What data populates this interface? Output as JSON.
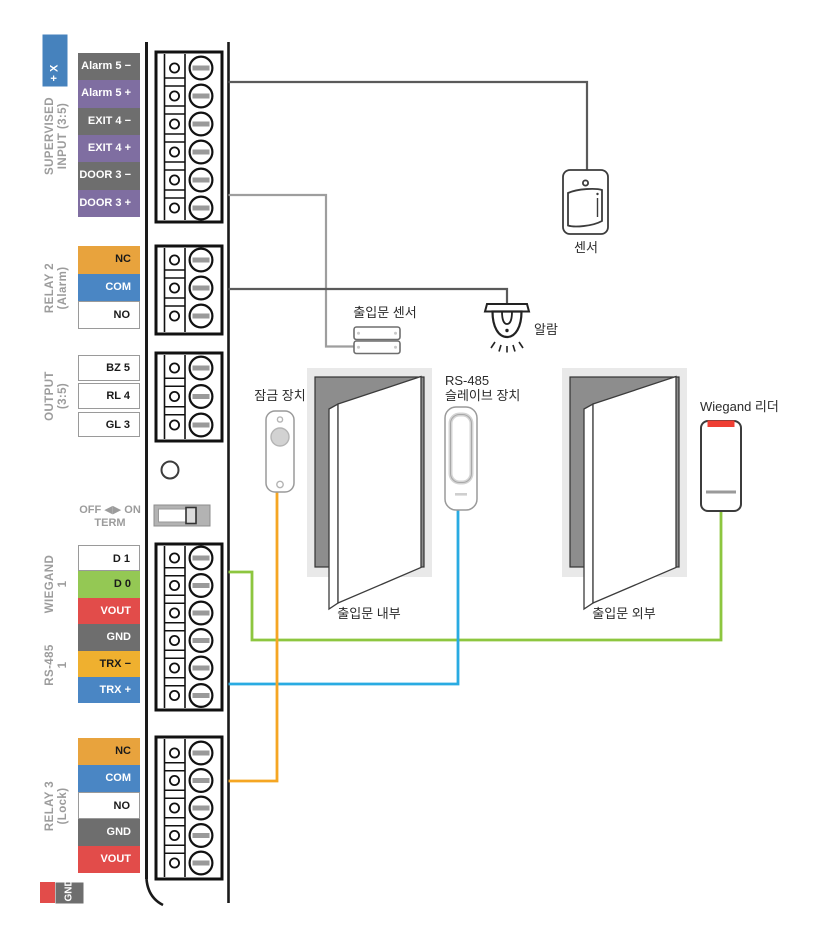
{
  "panel": {
    "aux_partial": "+ X",
    "side_labels": [
      {
        "lines": [
          "SUPERVISED",
          "INPUT (3:5)"
        ]
      },
      {
        "lines": [
          "RELAY 2",
          "(Alarm)"
        ]
      },
      {
        "lines": [
          "OUTPUT",
          "(3:5)"
        ]
      },
      {
        "lines": [
          "WIEGAND",
          "1"
        ]
      },
      {
        "lines": [
          "RS-485",
          "1"
        ]
      },
      {
        "lines": [
          "RELAY 3",
          "(Lock)"
        ]
      }
    ],
    "row_groups": [
      {
        "id": "supervised-input",
        "rows": [
          {
            "label": "Alarm 5 −",
            "bg": "#6e6e6e",
            "fg": "#ffffff"
          },
          {
            "label": "Alarm 5 +",
            "bg": "#7f6ea1",
            "fg": "#ffffff"
          },
          {
            "label": "EXIT 4 −",
            "bg": "#6e6e6e",
            "fg": "#ffffff"
          },
          {
            "label": "EXIT 4 +",
            "bg": "#7f6ea1",
            "fg": "#ffffff"
          },
          {
            "label": "DOOR 3 −",
            "bg": "#6e6e6e",
            "fg": "#ffffff"
          },
          {
            "label": "DOOR 3 +",
            "bg": "#7f6ea1",
            "fg": "#ffffff"
          }
        ]
      },
      {
        "id": "relay-2",
        "rows": [
          {
            "label": "NC",
            "bg": "#e8a33d",
            "fg": "#1a1a1a"
          },
          {
            "label": "COM",
            "bg": "#4a86c4",
            "fg": "#ffffff"
          },
          {
            "label": "NO",
            "bg": "#ffffff",
            "fg": "#1a1a1a"
          }
        ]
      },
      {
        "id": "output",
        "rows": [
          {
            "label": "BZ 5",
            "bg": "#ffffff",
            "fg": "#1a1a1a"
          },
          {
            "label": "RL 4",
            "bg": "#ffffff",
            "fg": "#1a1a1a"
          },
          {
            "label": "GL 3",
            "bg": "#ffffff",
            "fg": "#1a1a1a"
          }
        ]
      },
      {
        "id": "wiegand-rs485",
        "rows": [
          {
            "label": "D 1",
            "bg": "#ffffff",
            "fg": "#1a1a1a"
          },
          {
            "label": "D 0",
            "bg": "#94c854",
            "fg": "#1a1a1a"
          },
          {
            "label": "VOUT",
            "bg": "#e24c4a",
            "fg": "#ffffff"
          },
          {
            "label": "GND",
            "bg": "#6e6e6e",
            "fg": "#ffffff"
          },
          {
            "label": "TRX −",
            "bg": "#efb02f",
            "fg": "#1a1a1a"
          },
          {
            "label": "TRX +",
            "bg": "#4a86c4",
            "fg": "#ffffff"
          }
        ]
      },
      {
        "id": "relay-3",
        "rows": [
          {
            "label": "NC",
            "bg": "#e8a33d",
            "fg": "#1a1a1a"
          },
          {
            "label": "COM",
            "bg": "#4a86c4",
            "fg": "#ffffff"
          },
          {
            "label": "NO",
            "bg": "#ffffff",
            "fg": "#1a1a1a"
          },
          {
            "label": "GND",
            "bg": "#6e6e6e",
            "fg": "#ffffff"
          },
          {
            "label": "VOUT",
            "bg": "#e24c4a",
            "fg": "#ffffff"
          }
        ]
      }
    ],
    "term_switch_label": {
      "line1": "OFF ◀▶ ON",
      "line2": "TERM"
    },
    "bottom_partial_gnd": "GND"
  },
  "wires": [
    {
      "name": "sensor-wire",
      "color": "#5a5a5a",
      "from": "SUPERVISED INPUT",
      "to": "센서"
    },
    {
      "name": "door-sensor-wire",
      "color": "#9e9e9e",
      "from": "SUPERVISED INPUT",
      "to": "출입문 센서"
    },
    {
      "name": "alarm-wire",
      "color": "#5a5a5a",
      "from": "RELAY 2 COM",
      "to": "알람"
    },
    {
      "name": "wiegand-wire",
      "color": "#8dc63f",
      "from": "WIEGAND D 0",
      "to": "Wiegand 리더"
    },
    {
      "name": "rs485-wire",
      "color": "#29abe2",
      "from": "RS-485 TRX",
      "to": "RS-485 슬레이브 장치"
    },
    {
      "name": "lock-wire",
      "color": "#f5a623",
      "from": "RELAY 3 COM",
      "to": "잠금 장치"
    }
  ],
  "annotations": {
    "sensor": "센서",
    "door_sensor": "출입문 센서",
    "alarm": "알람",
    "lock": "잠금 장치",
    "rs485_device_line1": "RS-485",
    "rs485_device_line2": "슬레이브 장치",
    "wiegand_reader": "Wiegand 리더",
    "door_inside": "출입문 내부",
    "door_outside": "출입문 외부"
  },
  "colors": {
    "reader_accent": "#ef3e33",
    "door_frame": "#e9e9e9",
    "door_opening": "#8d8d8d"
  }
}
